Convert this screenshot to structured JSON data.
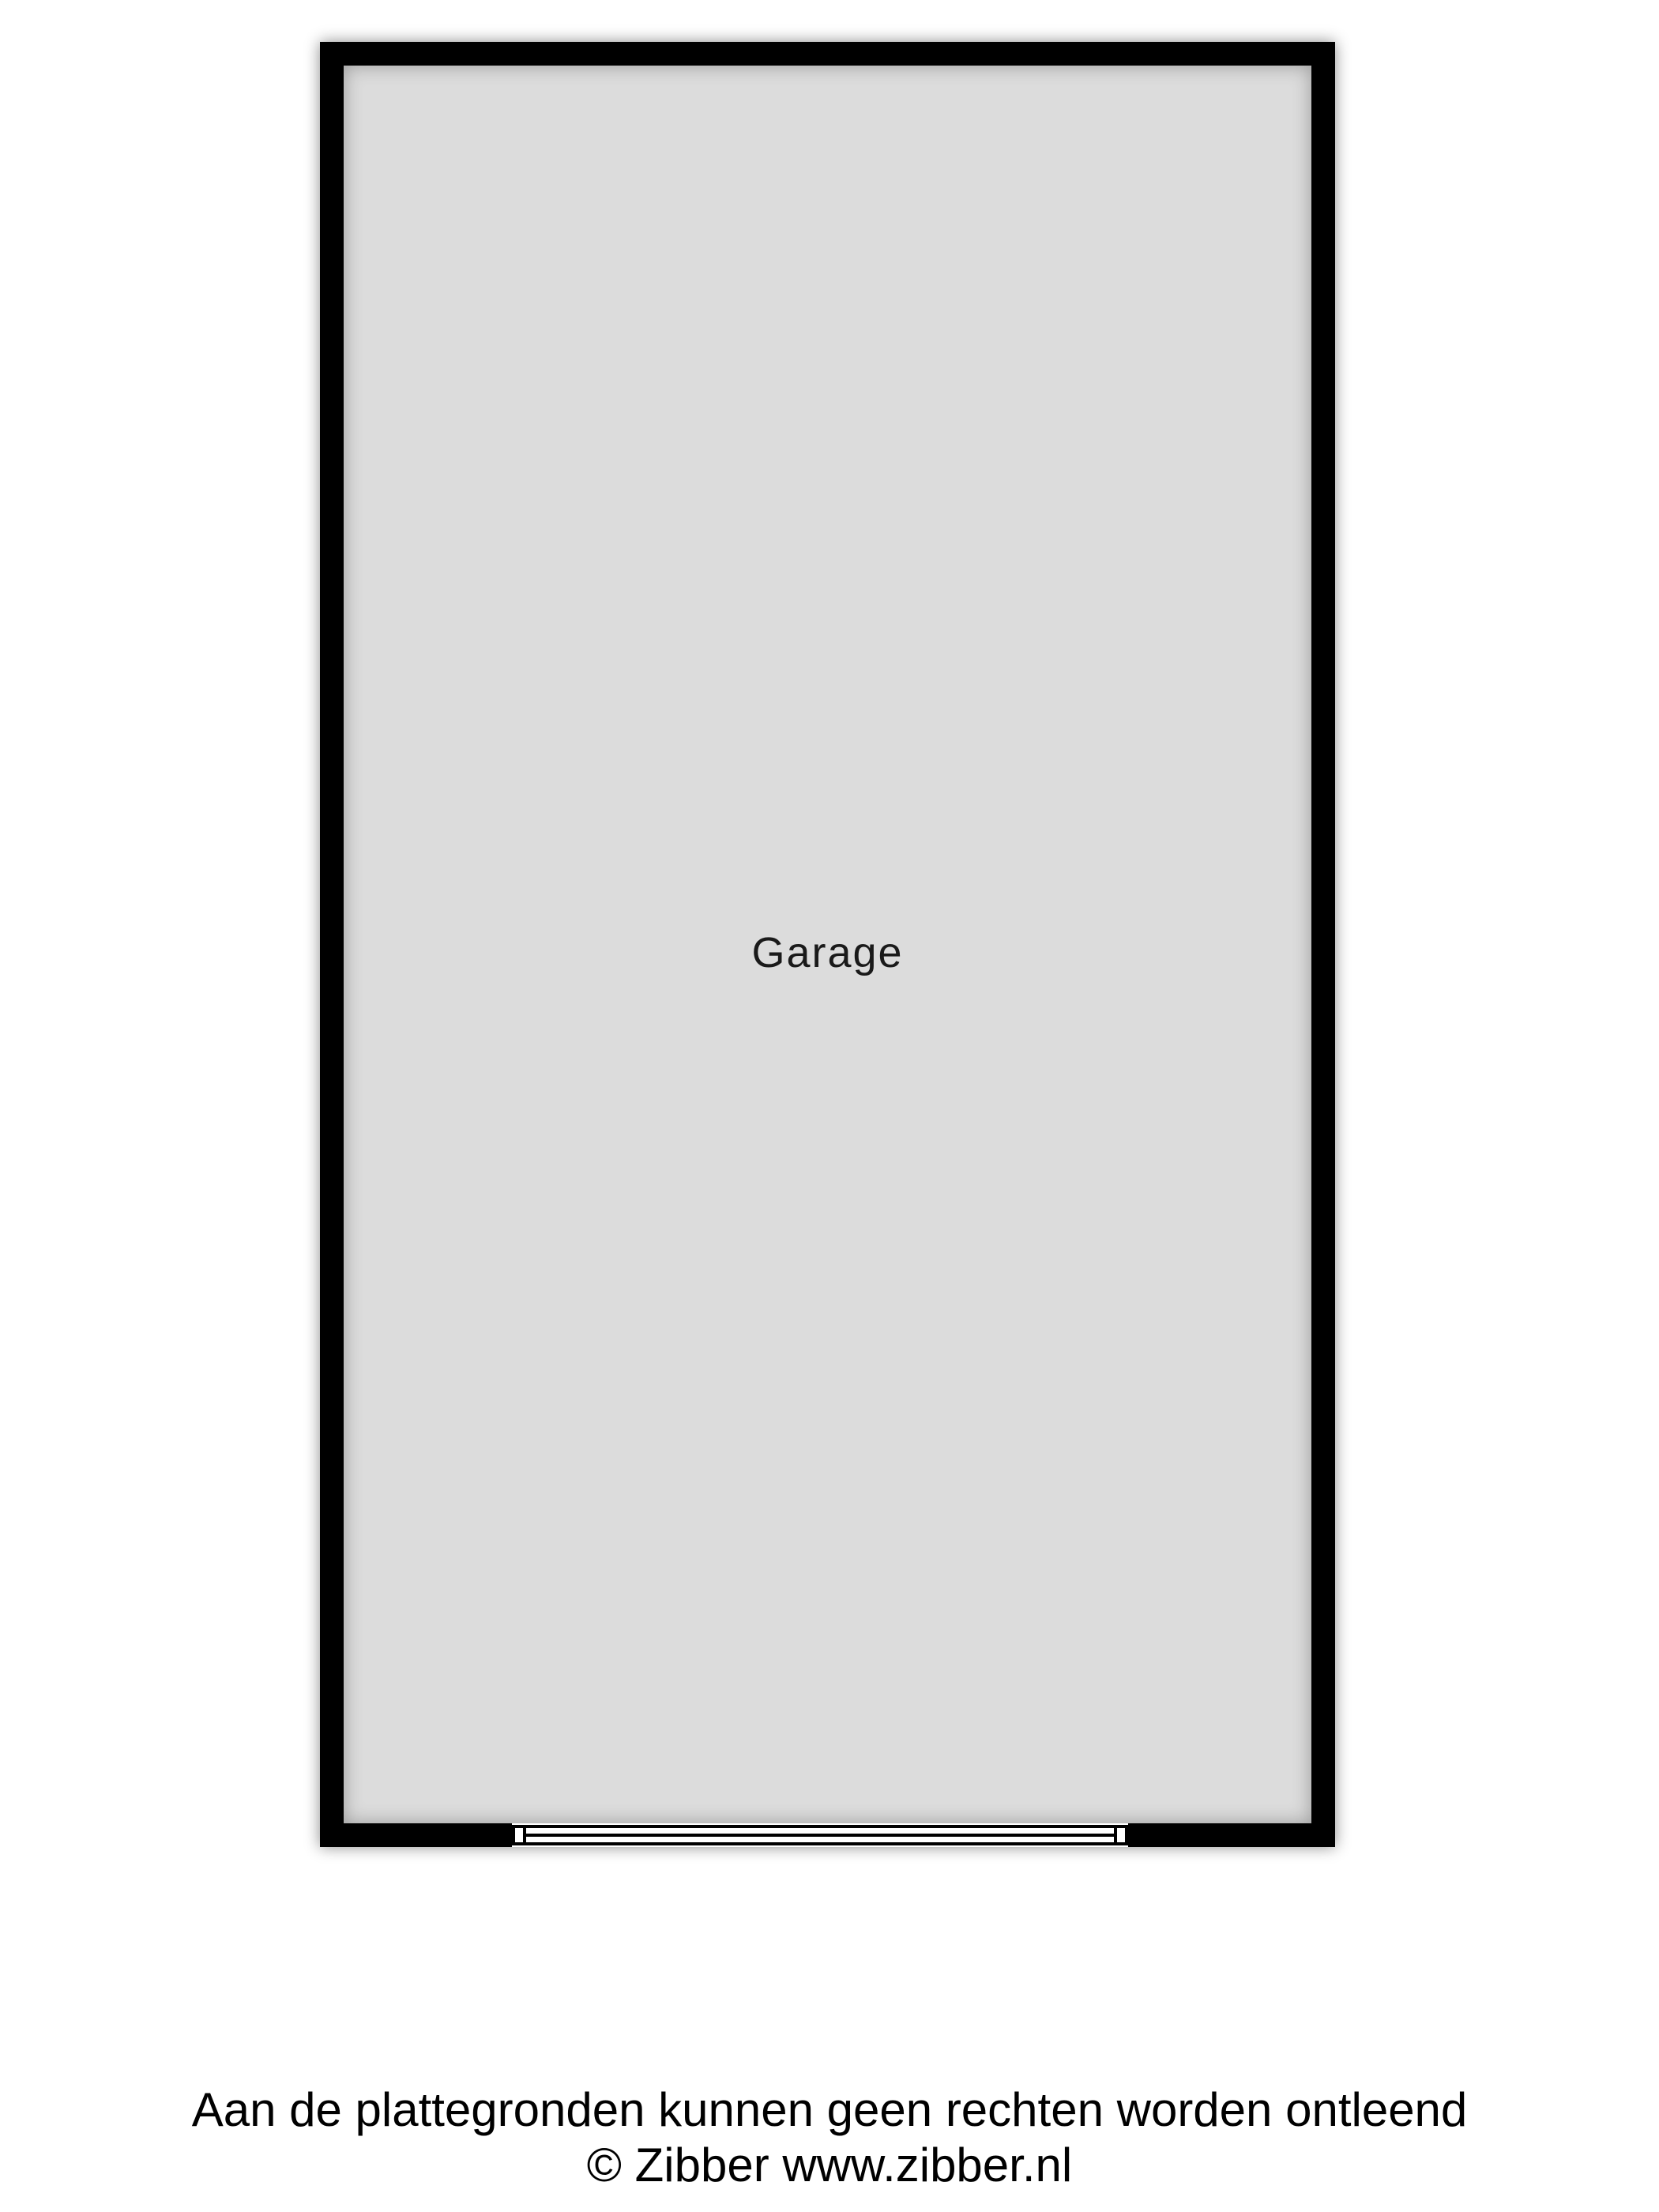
{
  "floorplan": {
    "room_label": "Garage",
    "door_symbol": "sectional-garage-door"
  },
  "footer": {
    "disclaimer": "Aan de plattegronden kunnen geen rechten worden ontleend",
    "copyright": "© Zibber www.zibber.nl"
  },
  "colors": {
    "wall": "#000000",
    "floor": "#dcdcdc",
    "page_background": "#ffffff",
    "text": "#1a1a1a"
  }
}
